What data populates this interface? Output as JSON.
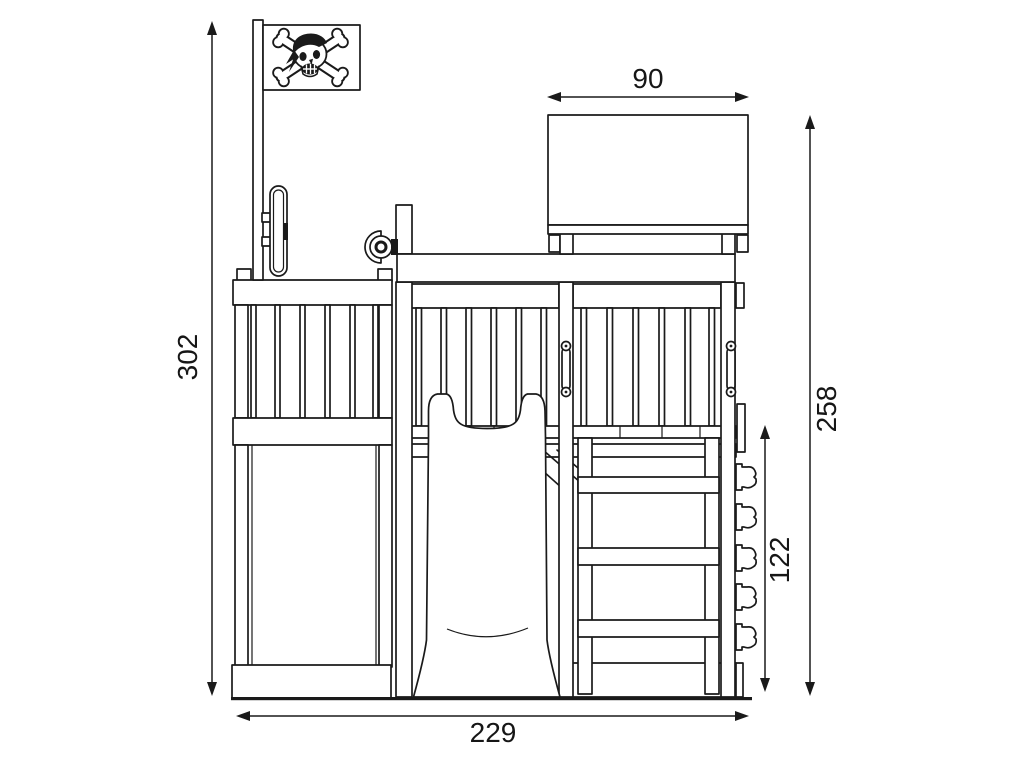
{
  "drawing": {
    "kind": "front-elevation technical drawing",
    "dimensions": {
      "overall_height": "302",
      "roof_width": "90",
      "tower_height": "258",
      "climbing_wall_height": "122",
      "overall_width": "229"
    },
    "icons": {
      "flag": "pirate-flag-skull-crossbones-icon",
      "steering_wheel": "steering-wheel-icon",
      "telescope": "telescope-icon",
      "climbing_holds": "climbing-hold-icon",
      "slide": "slide-front-view",
      "ladder": "ladder-front-view"
    },
    "colors": {
      "line": "#1a1a1a",
      "background": "#ffffff"
    }
  }
}
